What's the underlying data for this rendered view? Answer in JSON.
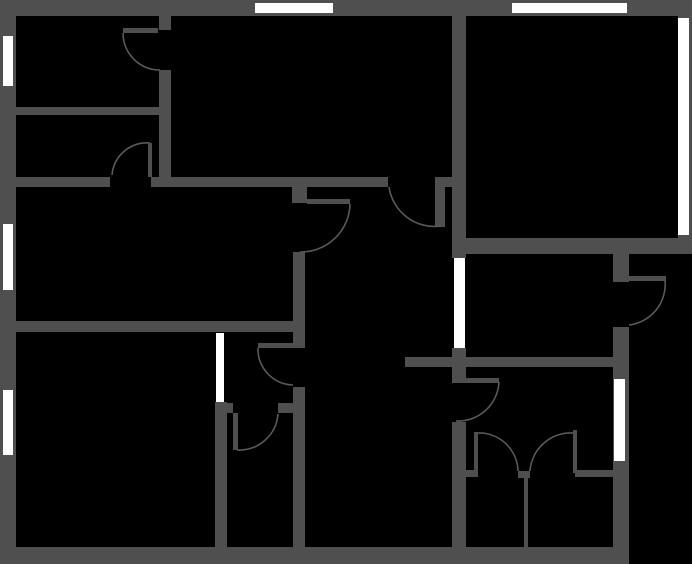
{
  "canvas": {
    "width": 692,
    "height": 564
  },
  "colors": {
    "background": "#000000",
    "wall": "#4f4f4f",
    "window": "#ffffff",
    "arc": "#5a5a5a"
  },
  "floorplan": {
    "walls": [
      {
        "name": "exterior-wall-top",
        "x": 0,
        "y": 0,
        "w": 692,
        "h": 16
      },
      {
        "name": "exterior-wall-left",
        "x": 0,
        "y": 0,
        "w": 16,
        "h": 564
      },
      {
        "name": "exterior-wall-bottom",
        "x": 0,
        "y": 547,
        "w": 629,
        "h": 17
      },
      {
        "name": "exterior-wall-right",
        "x": 678,
        "y": 0,
        "w": 14,
        "h": 254
      },
      {
        "name": "exterior-wall-right-lower-stub",
        "x": 613,
        "y": 254,
        "w": 16,
        "h": 28
      },
      {
        "name": "exterior-wall-right-lower",
        "x": 613,
        "y": 327,
        "w": 16,
        "h": 220
      },
      {
        "name": "wall-topleft-vertical-upper",
        "x": 159,
        "y": 16,
        "w": 12,
        "h": 14
      },
      {
        "name": "wall-topleft-vertical-lower",
        "x": 159,
        "y": 70,
        "w": 12,
        "h": 107
      },
      {
        "name": "wall-topleft-horizontal",
        "x": 16,
        "y": 107,
        "w": 143,
        "h": 8
      },
      {
        "name": "wall-main-horizontal-west",
        "x": 16,
        "y": 177,
        "w": 94,
        "h": 10
      },
      {
        "name": "wall-main-horizontal-mid",
        "x": 151,
        "y": 177,
        "w": 237,
        "h": 10
      },
      {
        "name": "wall-main-horizontal-east",
        "x": 435,
        "y": 177,
        "w": 17,
        "h": 10
      },
      {
        "name": "wall-hall-west-pier",
        "x": 292,
        "y": 187,
        "w": 15,
        "h": 16
      },
      {
        "name": "wall-hall-west-mid",
        "x": 293,
        "y": 252,
        "w": 12,
        "h": 96
      },
      {
        "name": "wall-hall-west-lower",
        "x": 293,
        "y": 387,
        "w": 12,
        "h": 160
      },
      {
        "name": "wall-bigroom-south",
        "x": 16,
        "y": 321,
        "w": 277,
        "h": 11
      },
      {
        "name": "wall-bottomleft-east",
        "x": 215,
        "y": 402,
        "w": 12,
        "h": 145
      },
      {
        "name": "wall-anteroom-south-west",
        "x": 215,
        "y": 403,
        "w": 18,
        "h": 10
      },
      {
        "name": "wall-anteroom-south-east",
        "x": 278,
        "y": 403,
        "w": 15,
        "h": 10
      },
      {
        "name": "wall-spine-upper",
        "x": 452,
        "y": 16,
        "w": 14,
        "h": 242
      },
      {
        "name": "wall-spine-mid",
        "x": 452,
        "y": 348,
        "w": 14,
        "h": 35
      },
      {
        "name": "wall-spine-lower",
        "x": 452,
        "y": 422,
        "w": 14,
        "h": 125
      },
      {
        "name": "wall-topright-south",
        "x": 452,
        "y": 238,
        "w": 240,
        "h": 16
      },
      {
        "name": "wall-middle-horizontal",
        "x": 405,
        "y": 357,
        "w": 224,
        "h": 10
      },
      {
        "name": "wall-bath-north-west",
        "x": 466,
        "y": 470,
        "w": 8,
        "h": 7
      },
      {
        "name": "wall-bath-north-center",
        "x": 518,
        "y": 471,
        "w": 12,
        "h": 7
      },
      {
        "name": "wall-bath-north-east",
        "x": 575,
        "y": 470,
        "w": 38,
        "h": 7
      },
      {
        "name": "wall-bath-divider",
        "x": 524,
        "y": 478,
        "w": 4,
        "h": 69
      }
    ],
    "windows": [
      {
        "name": "window-left-top",
        "x": 3,
        "y": 36,
        "w": 10,
        "h": 50
      },
      {
        "name": "window-left-middle",
        "x": 3,
        "y": 224,
        "w": 10,
        "h": 66
      },
      {
        "name": "window-left-bottom",
        "x": 3,
        "y": 390,
        "w": 10,
        "h": 65
      },
      {
        "name": "window-top-left",
        "x": 255,
        "y": 3,
        "w": 78,
        "h": 10
      },
      {
        "name": "window-top-right",
        "x": 512,
        "y": 3,
        "w": 115,
        "h": 10
      },
      {
        "name": "window-right",
        "x": 678,
        "y": 18,
        "w": 11,
        "h": 217
      },
      {
        "name": "window-right-lower",
        "x": 614,
        "y": 379,
        "w": 11,
        "h": 82
      },
      {
        "name": "opening-hall-east",
        "x": 454,
        "y": 258,
        "w": 11,
        "h": 90
      },
      {
        "name": "opening-bottomleft",
        "x": 216,
        "y": 333,
        "w": 8,
        "h": 69
      }
    ],
    "door_leaves": [
      {
        "name": "door-leaf-topleft",
        "x": 123,
        "y": 28,
        "w": 35,
        "h": 5
      },
      {
        "name": "door-leaf-roomb",
        "x": 148,
        "y": 143,
        "w": 4,
        "h": 34
      },
      {
        "name": "door-leaf-hall-north",
        "x": 435,
        "y": 187,
        "w": 10,
        "h": 40
      },
      {
        "name": "door-leaf-hall-west",
        "x": 307,
        "y": 199,
        "w": 43,
        "h": 5
      },
      {
        "name": "door-leaf-anteroom",
        "x": 258,
        "y": 343,
        "w": 35,
        "h": 5
      },
      {
        "name": "door-leaf-anteroom-inner",
        "x": 233,
        "y": 413,
        "w": 5,
        "h": 37
      },
      {
        "name": "door-leaf-hall-east",
        "x": 466,
        "y": 378,
        "w": 33,
        "h": 5
      },
      {
        "name": "door-leaf-balcony",
        "x": 628,
        "y": 276,
        "w": 38,
        "h": 5
      },
      {
        "name": "door-leaf-bath-left",
        "x": 474,
        "y": 432,
        "w": 4,
        "h": 45
      },
      {
        "name": "door-leaf-bath-right",
        "x": 573,
        "y": 430,
        "w": 4,
        "h": 43
      }
    ],
    "door_arcs": [
      {
        "name": "door-arc-topleft",
        "x1": 123,
        "y1": 33,
        "x2": 160,
        "y2": 70,
        "r": 37,
        "sweep": 0
      },
      {
        "name": "door-arc-roomb",
        "x1": 150,
        "y1": 143,
        "x2": 112,
        "y2": 175,
        "r": 35,
        "sweep": 0
      },
      {
        "name": "door-arc-hall-north",
        "x1": 389,
        "y1": 187,
        "x2": 441,
        "y2": 226,
        "r": 46,
        "sweep": 0
      },
      {
        "name": "door-arc-hall-west",
        "x1": 350,
        "y1": 204,
        "x2": 300,
        "y2": 252,
        "r": 49,
        "sweep": 1
      },
      {
        "name": "door-arc-anteroom",
        "x1": 258,
        "y1": 348,
        "x2": 293,
        "y2": 385,
        "r": 36,
        "sweep": 0
      },
      {
        "name": "door-arc-anteroom-inner",
        "x1": 237,
        "y1": 450,
        "x2": 278,
        "y2": 414,
        "r": 39,
        "sweep": 0
      },
      {
        "name": "door-arc-hall-east",
        "x1": 499,
        "y1": 382,
        "x2": 456,
        "y2": 421,
        "r": 41,
        "sweep": 1
      },
      {
        "name": "door-arc-balcony",
        "x1": 665,
        "y1": 280,
        "x2": 629,
        "y2": 325,
        "r": 41,
        "sweep": 1
      },
      {
        "name": "door-arc-bath-left",
        "x1": 478,
        "y1": 433,
        "x2": 518,
        "y2": 471,
        "r": 39,
        "sweep": 1
      },
      {
        "name": "door-arc-bath-right",
        "x1": 573,
        "y1": 433,
        "x2": 530,
        "y2": 471,
        "r": 41,
        "sweep": 0
      }
    ]
  }
}
